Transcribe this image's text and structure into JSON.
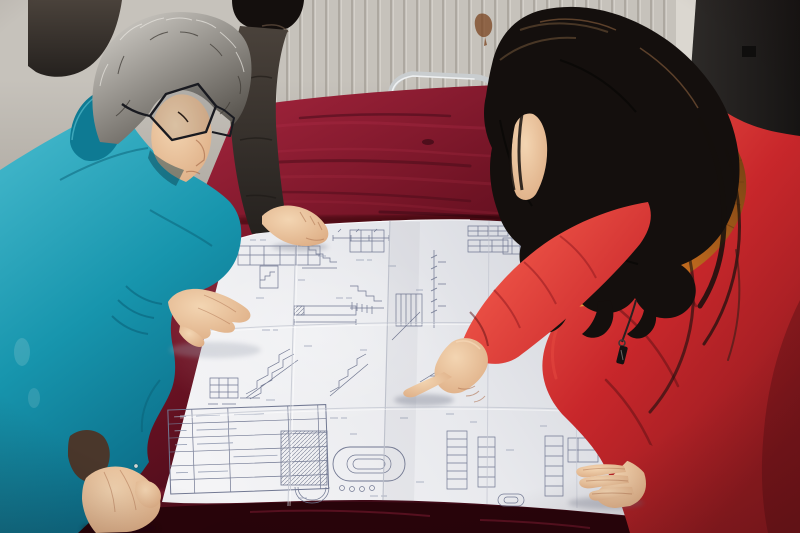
{
  "meta": {
    "type": "photograph",
    "width": 800,
    "height": 533,
    "description": "Indoor photo: people lean over a large folded construction blueprint spread on a dark red velvet table. A gray-haired man in a teal work jacket and glasses studies the drawings at left, a woman in a red down coat with an orange fur-trimmed hood points at a detail, and a third person in a dark jacket rests a hand on the sheet. Behind them: a pale panelled wall with radiator fins, a chrome-framed chair with a red seat, and a dark panel at right."
  },
  "scene": {
    "objects": {
      "wall": {
        "label": "pale panelled wall with radiator fins"
      },
      "rust": {
        "label": "rust stain on wall"
      },
      "panel": {
        "label": "dark panel at right side"
      },
      "chair": {
        "label": "chrome-framed chair with red velvet seat"
      },
      "table": {
        "label": "dark red velvet covered table"
      },
      "blueprint": {
        "label": "folded construction blueprint with stair details, section drawings and title tables"
      },
      "man_teal": {
        "label": "gray-haired man in teal work jacket wearing glasses"
      },
      "bg_person": {
        "label": "person in dark jacket resting a hand on the blueprint"
      },
      "woman_red": {
        "label": "woman in red fur-trimmed down coat pointing at the blueprint"
      }
    }
  },
  "colors": {
    "wall": "#c6c2bb",
    "wall_slat": "#a8a39b",
    "wall_slat_light": "#d8d4cd",
    "wall_stripe": "#dbd7d0",
    "panel_hi": "#2e2b29",
    "panel_lo": "#161413",
    "chrome": "#c9cdcf",
    "chair_red": "#a31d2e",
    "table_hi": "#9a2138",
    "table_mid": "#6f1324",
    "table_dark": "#400a17",
    "table_edge": "#270409",
    "velvet_streak": "#b03049",
    "paper_light": "#f4f4f6",
    "paper_mid": "#e8e9ed",
    "paper_shade": "#d3d5dc",
    "ink": "#717892",
    "ink_light": "#98a0b5",
    "teal_light": "#3fb4c8",
    "teal_mid": "#1795ad",
    "teal_dark": "#0b6d88",
    "teal_collar": "#0e7a93",
    "dark_jacket_hi": "#4a423b",
    "dark_jacket_lo": "#25211e",
    "hair_black": "#140f0d",
    "hair_brown": "#55402c",
    "hair_gray_light": "#d9d6d0",
    "hair_gray_dark": "#55514b",
    "skin_light": "#f3d5b2",
    "skin_mid": "#ddac83",
    "skin_shadow": "#ad7250",
    "glasses": "#191a20",
    "rust": "#7a431f",
    "red_light": "#ea4f44",
    "red_mid": "#c8272b",
    "red_dark": "#941b20",
    "red_deep": "#5c1013",
    "fur_light": "#f0a844",
    "fur_mid": "#c06a1e",
    "fur_dark": "#6f3d12"
  }
}
